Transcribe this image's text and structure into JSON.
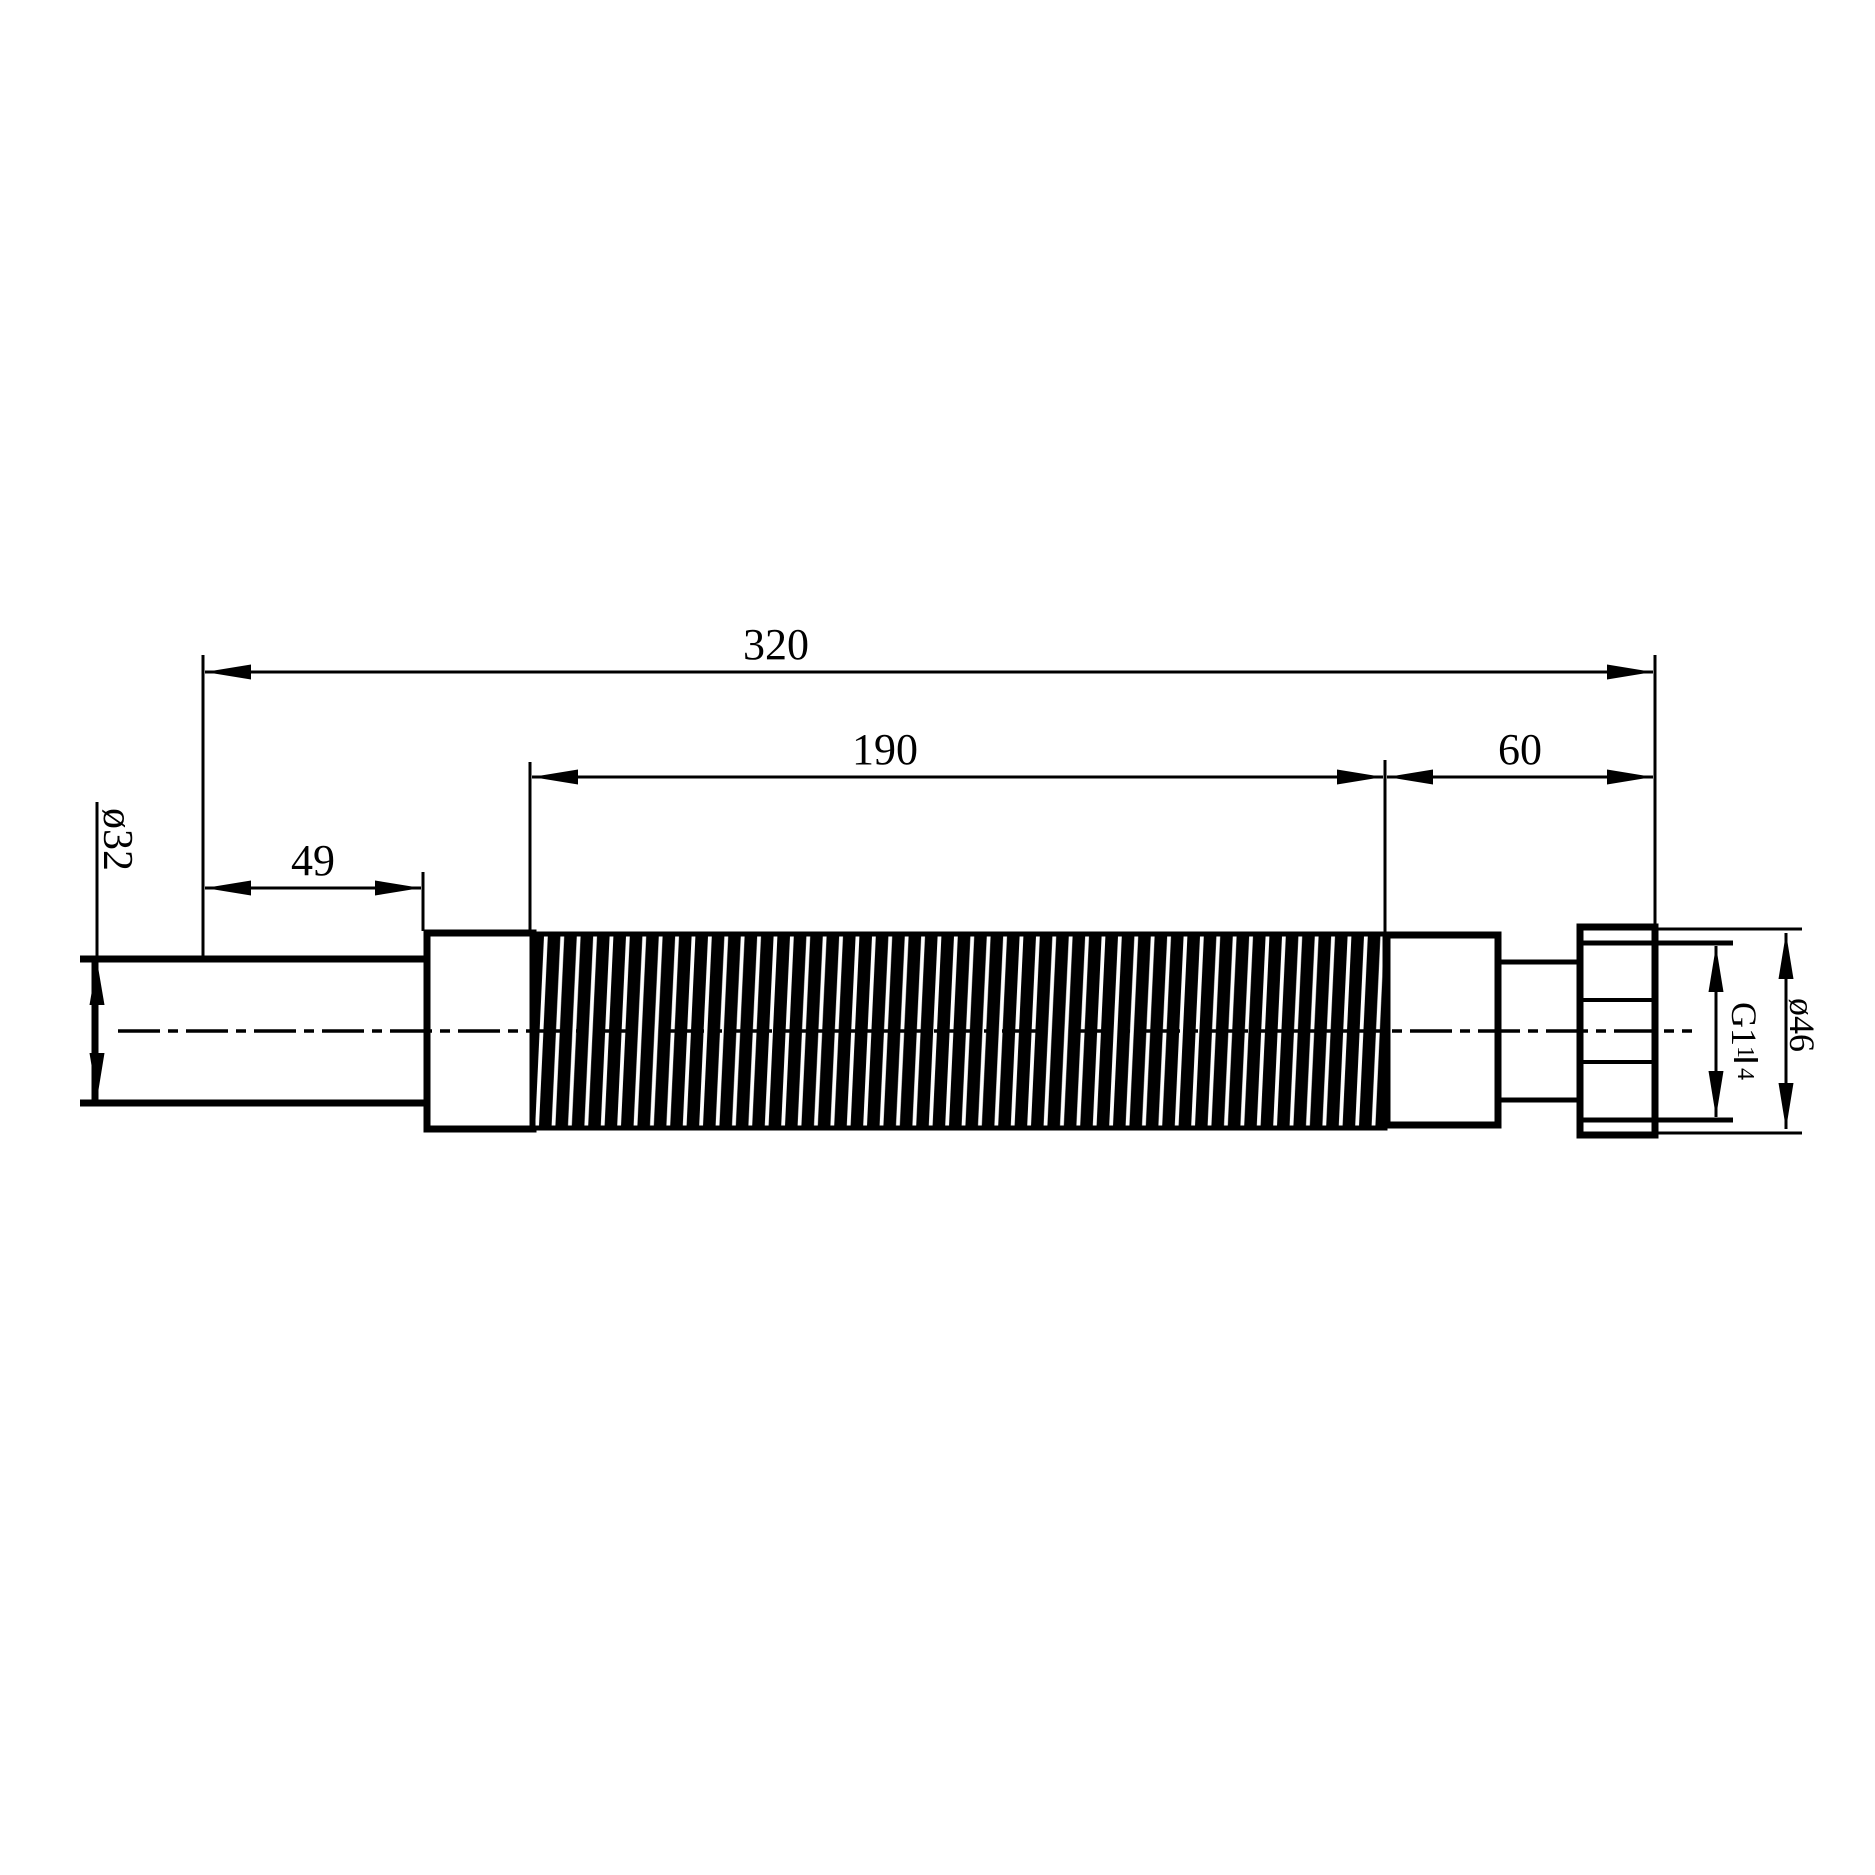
{
  "drawing": {
    "type": "technical-dimension-drawing",
    "subject": "flexible corrugated waste pipe with compression nut",
    "colors": {
      "line": "#000000",
      "background": "#ffffff"
    },
    "dimensions": {
      "overall_length": "320",
      "hose_length": "190",
      "outlet_length": "60",
      "inlet_length": "49",
      "inlet_diameter": "ø32",
      "nut_diameter": "ø46",
      "thread": {
        "prefix": "G1",
        "numerator": "1",
        "denominator": "4"
      }
    }
  }
}
